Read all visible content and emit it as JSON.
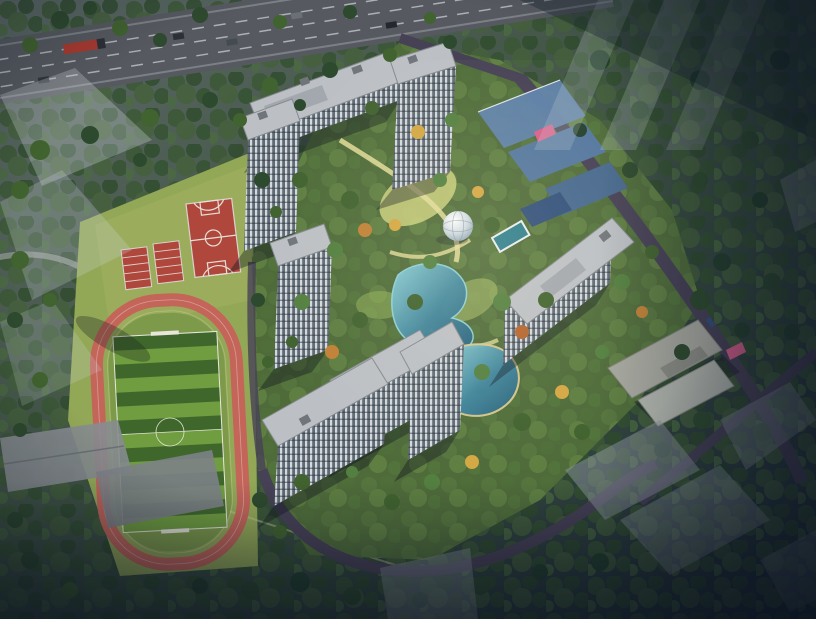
{
  "scene": {
    "type": "architectural-aerial-rendering",
    "time_of_day": "dusk",
    "subject": "bird's-eye masterplan rendering of a residential compound beside a school sports ground",
    "features": [
      "multi-lane highway with vehicles",
      "school sports ground with red running track and striped soccer field",
      "basketball court and two training courts",
      "residential high-rise towers with gray roofs and glazed facades",
      "central landscaped garden with geodesic dome pavilion",
      "two free-form ponds and a rectangular outdoor pool",
      "yellow garden paths",
      "internal perimeter roads",
      "pink entrance gate features",
      "blue-roofed podium buildings",
      "low-rise clubhouse",
      "translucent ghost buildings of future phases",
      "dense tree belts and autumn-colored trees"
    ]
  },
  "colors": {
    "highway_asphalt": "#56595f",
    "truck_red": "#a83a30",
    "school_grass": "#93a857",
    "infield_grass": "#7d9a4a",
    "track_red": "#c4655a",
    "court_red": "#b0473d",
    "site_green": "#4f6b3a",
    "internal_road": "#474156",
    "roof_gray": "#bcc0c5",
    "podium_blue": "#5f82ab",
    "pond_light": "#8fd4de",
    "pool_teal": "#2f7f8e",
    "path_yellow": "#e3dc9a",
    "lawn_yellow": "#c9cf7d",
    "gate_pink": "#d85f8c",
    "ghost_building": "#d3dade"
  }
}
